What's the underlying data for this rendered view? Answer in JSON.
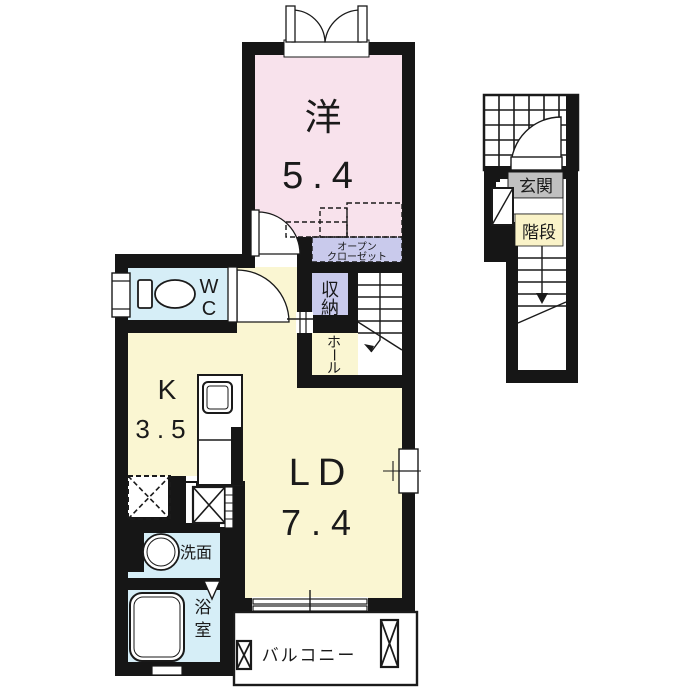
{
  "labels": {
    "western_name": "洋",
    "western_size": "5.4",
    "closet_line1": "オープン",
    "closet_line2": "クローゼット",
    "storage_char1": "収",
    "storage_char2": "納",
    "wc_w": "W",
    "wc_c": "C",
    "hall_char1": "ホ",
    "hall_char2": "ー",
    "hall_char3": "ル",
    "kitchen_name": "K",
    "kitchen_size": "3.5",
    "living_name": "LD",
    "living_size": "7.4",
    "washroom": "洗面",
    "bath_char1": "浴",
    "bath_char2": "室",
    "balcony": "バルコニー",
    "entrance": "玄関",
    "stairs": "階段"
  },
  "colors": {
    "wall": "#161616",
    "room_pink": "#F8E2EC",
    "room_yellow": "#FAF6D2",
    "room_blue": "#D6EEF7",
    "room_lavender": "#C9CAEC",
    "genkan_gray": "#C0C0C0",
    "kaidan_yellow": "#FAF3C8",
    "background": "#FFFFFF"
  }
}
